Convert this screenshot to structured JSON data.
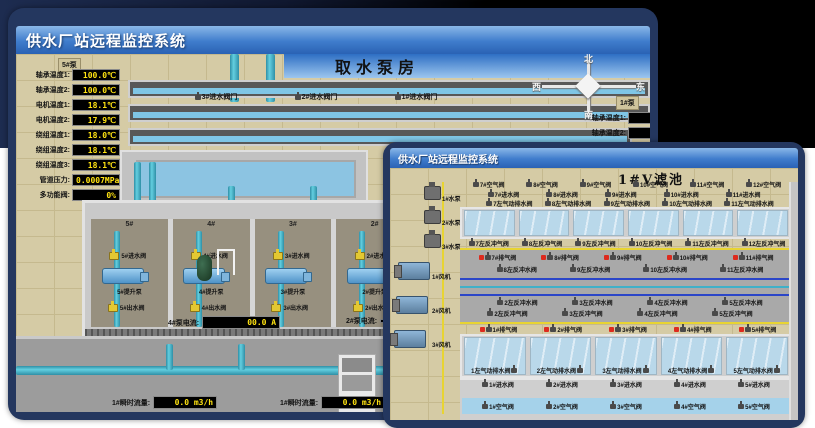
{
  "back_window": {
    "title": "供水厂站远程监控系统",
    "scene_title": "取水泵房",
    "pump_panel_title": "5#泵",
    "readouts": [
      {
        "label": "轴承温度1:",
        "value": "100.0℃"
      },
      {
        "label": "轴承温度2:",
        "value": "100.0℃"
      },
      {
        "label": "电机温度1:",
        "value": "18.1℃"
      },
      {
        "label": "电机温度2:",
        "value": "17.9℃"
      },
      {
        "label": "绕组温度1:",
        "value": "18.0℃"
      },
      {
        "label": "绕组温度2:",
        "value": "18.1℃"
      },
      {
        "label": "绕组温度3:",
        "value": "18.1℃"
      },
      {
        "label": "管道压力:",
        "value": "0.0007MPa"
      },
      {
        "label": "多功能阀:",
        "value": "0%"
      }
    ],
    "intake_valves": [
      "3#进水阀门",
      "2#进水阀门",
      "1#进水阀门"
    ],
    "compass": {
      "north": "北",
      "south": "南",
      "west": "西",
      "east": "东"
    },
    "right_panel": {
      "pump_label": "1#泵",
      "readout_labels": [
        "轴承温度1:",
        "轴承温度2:"
      ]
    },
    "pump_bays": [
      {
        "bay": "5#",
        "inlet": "5#进水阀",
        "pump": "5#提升泵",
        "outlet": "5#出水阀"
      },
      {
        "bay": "4#",
        "inlet": "4#进水阀",
        "pump": "4#提升泵",
        "outlet": "4#出水阀"
      },
      {
        "bay": "3#",
        "inlet": "3#进水阀",
        "pump": "3#提升泵",
        "outlet": "3#出水阀"
      },
      {
        "bay": "2#",
        "inlet": "2#进水阀",
        "pump": "2#提升泵",
        "outlet": "2#出水阀"
      }
    ],
    "current_readouts": [
      {
        "label": "4#泵电流:",
        "value": "00.0 A"
      },
      {
        "label": "2#泵电流:",
        "value": ""
      }
    ],
    "flow_readouts": [
      {
        "label": "1#瞬时流量:",
        "value": "0.0 m3/h"
      },
      {
        "label": "1#瞬时流量:",
        "value": "0.0 m3/h"
      }
    ]
  },
  "front_window": {
    "title": "供水厂站远程监控系统",
    "scene_title": "1#V滤池",
    "left_equipment": {
      "pumps": [
        "1#水泵",
        "2#水泵",
        "3#水泵"
      ],
      "blowers": [
        "1#风机",
        "2#风机",
        "3#风机"
      ]
    },
    "rows": {
      "top_air": [
        "7#空气阀",
        "8#空气阀",
        "9#空气阀",
        "10#空气阀",
        "11#空气阀",
        "12#空气阀"
      ],
      "top_inlet": [
        "7#进水阀",
        "8#进水阀",
        "9#进水阀",
        "10#进水阀",
        "11#进水阀"
      ],
      "top_drain": [
        "7左气动排水阀",
        "8左气动排水阀",
        "9左气动排水阀",
        "10左气动排水阀",
        "11左气动排水阀"
      ],
      "top_backwash_air": [
        "7左反冲气阀",
        "8左反冲气阀",
        "9左反冲气阀",
        "10左反冲气阀",
        "11左反冲气阀",
        "12左反冲气阀"
      ],
      "top_exhaust": [
        "7#排气阀",
        "8#排气阀",
        "9#排气阀",
        "10#排气阀",
        "11#排气阀"
      ],
      "top_backwash_water": [
        "8左反冲水阀",
        "9左反冲水阀",
        "10左反冲水阀",
        "11左反冲水阀"
      ],
      "bottom_backwash_water": [
        "2左反冲水阀",
        "3左反冲水阀",
        "4左反冲水阀",
        "5左反冲水阀"
      ],
      "bottom_backwash_air": [
        "2左反冲气阀",
        "3左反冲气阀",
        "4左反冲气阀",
        "5左反冲气阀"
      ],
      "bottom_exhaust": [
        "1#排气阀",
        "2#排气阀",
        "3#排气阀",
        "4#排气阀",
        "5#排气阀"
      ],
      "bottom_drain": [
        "1左气动排水阀",
        "2左气动排水阀",
        "3左气动排水阀",
        "4左气动排水阀",
        "5左气动排水阀"
      ],
      "bottom_inlet": [
        "1#进水阀",
        "2#进水阀",
        "3#进水阀",
        "4#进水阀",
        "5#进水阀"
      ],
      "bottom_air": [
        "1#空气阀",
        "2#空气阀",
        "3#空气阀",
        "4#空气阀",
        "5#空气阀"
      ]
    }
  }
}
